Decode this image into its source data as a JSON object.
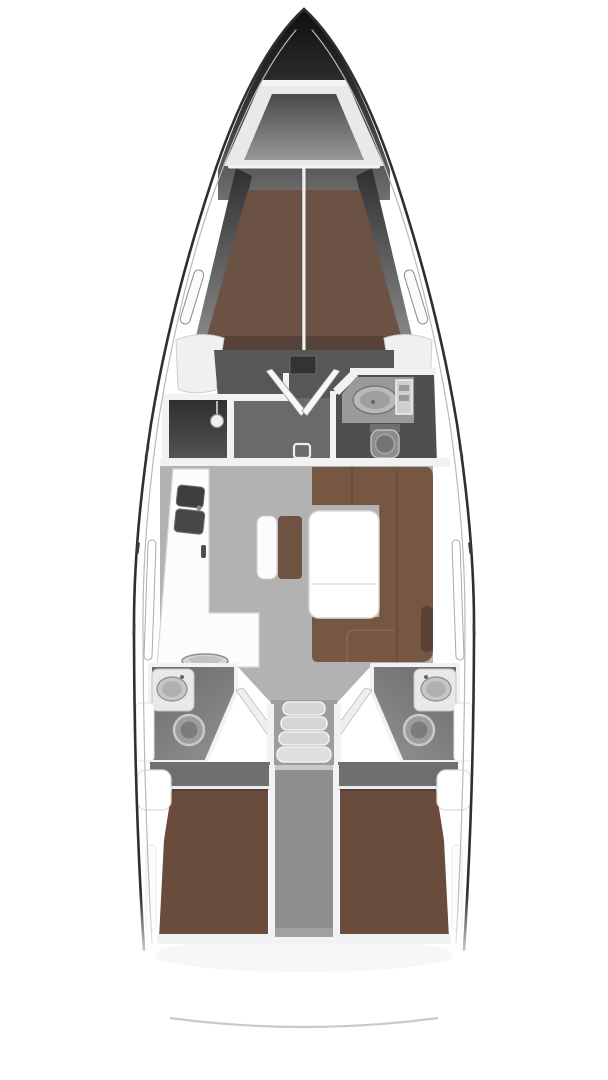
{
  "diagram": {
    "kind": "sailing-yacht-interior-floor-plan",
    "view": "top-down-bow-up",
    "areas": {
      "hull": "Yacht hull outline",
      "anchor_locker": "Anchor locker",
      "forward_cabin": "Forward cabin with V-berth",
      "shower_room": "Forward shower room",
      "forward_head": "Forward head with washbasin and toilet",
      "vestibule": "Forward vestibule with double doors",
      "salon": "Salon with U-shaped settee and table",
      "galley": "L-shaped galley with double sink and stove",
      "companionway": "Companionway steps",
      "engine_compartment": "Engine compartment",
      "aft_head_port": "Aft head port side",
      "aft_head_starboard": "Aft head starboard side",
      "aft_cabin_port": "Aft double cabin port",
      "aft_cabin_starboard": "Aft double cabin starboard",
      "stern": "Stern with transom"
    },
    "colors": {
      "hull_outline": "#2f2f2f",
      "inner_rail": "#b9b9b9",
      "wall_white": "#f2f2f2",
      "furniture_white": "#fcfcfc",
      "forward_berth_brown": "#6b5245",
      "headboard_brown": "#57423a",
      "sofa_brown": "#765741",
      "sofa_seam_brown": "#5e4636",
      "bench_brown": "#6e5242",
      "armrest_brown": "#5a4234",
      "aft_bed_brown": "#6a4c3d",
      "salon_floor_gray": "#b2b2b2",
      "vestibule_floor_gray": "#6a6a6a",
      "forward_floor_gray": "#575757",
      "head_floor_gray": "#4f4f4f",
      "corridor_gray": "#6f6f6f",
      "engine_gray": "#8f8f8f",
      "stairs_gray": "#d6d6d6",
      "fixture_gray": "#9a9a9a",
      "sink_dark_gray": "#3e3e3e",
      "transom_line_gray": "#c9c9c9"
    }
  }
}
